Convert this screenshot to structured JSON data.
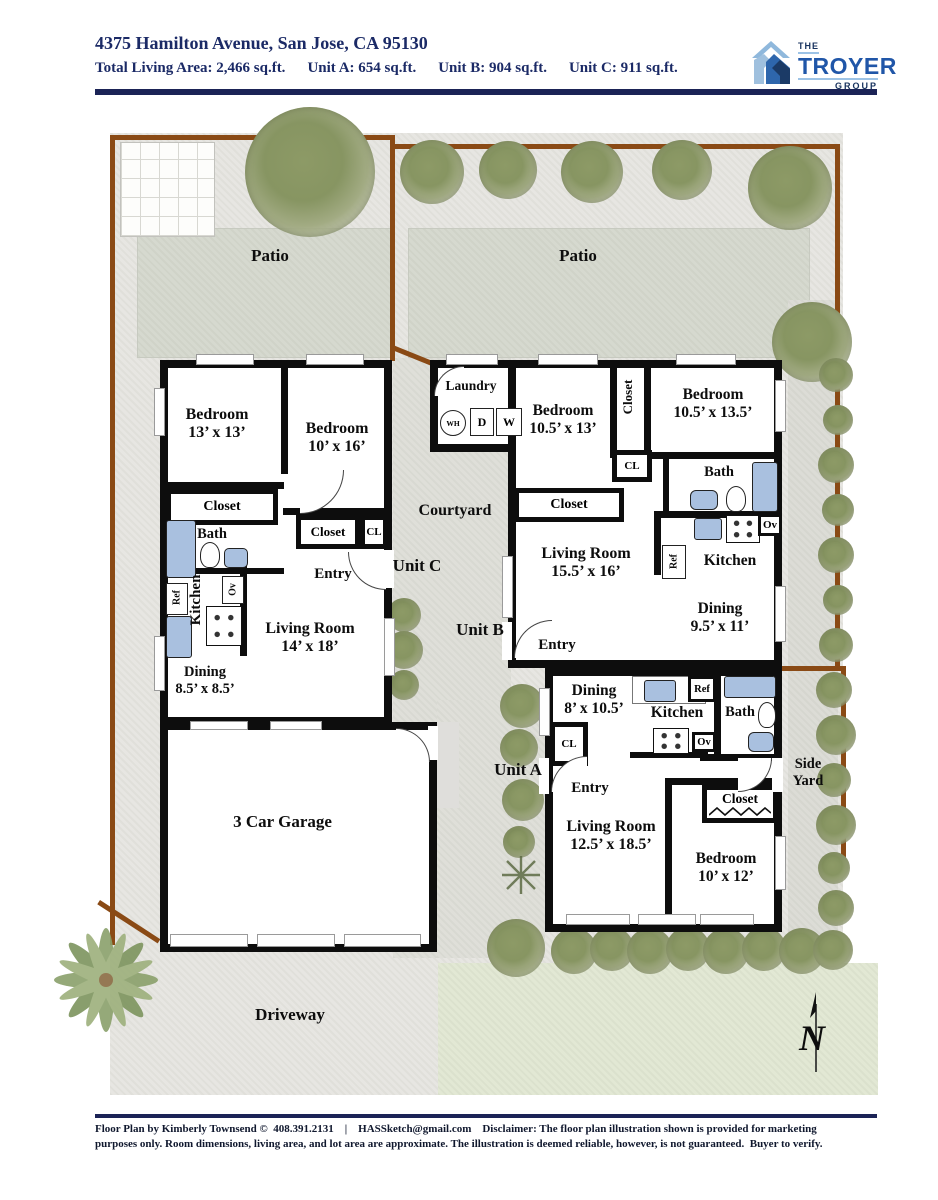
{
  "header": {
    "address": "4375 Hamilton Avenue, San Jose, CA 95130",
    "stats": [
      "Total Living Area: 2,466 sq.ft.",
      "Unit A: 654 sq.ft.",
      "Unit B: 904 sq.ft.",
      "Unit C: 911 sq.ft."
    ],
    "logo": {
      "line1": "THE",
      "line2": "TROYER",
      "line3": "GROUP"
    }
  },
  "site": {
    "patio_left": "Patio",
    "patio_right": "Patio",
    "courtyard": "Courtyard",
    "driveway": "Driveway",
    "side_yard": "Side Yard",
    "garage": "3 Car Garage",
    "compass_n": "N"
  },
  "unit_c": {
    "label": "Unit C",
    "bedroom1": {
      "name": "Bedroom",
      "dims": "13’ x 13’"
    },
    "bedroom2": {
      "name": "Bedroom",
      "dims": "10’ x 16’"
    },
    "closet1": "Closet",
    "bath": "Bath",
    "kitchen": "Kitchen",
    "ref": "Ref",
    "ov": "Ov",
    "dining": {
      "name": "Dining",
      "dims": "8.5’ x 8.5’"
    },
    "living": {
      "name": "Living Room",
      "dims": "14’ x 18’"
    },
    "entry": "Entry",
    "closet2": "Closet",
    "cl": "CL"
  },
  "unit_b": {
    "label": "Unit B",
    "laundry": "Laundry",
    "wh": "WH",
    "d": "D",
    "w": "W",
    "bedroom1": {
      "name": "Bedroom",
      "dims": "10.5’ x 13’"
    },
    "closet_tall": "Closet",
    "cl": "CL",
    "bedroom2": {
      "name": "Bedroom",
      "dims": "10.5’ x 13.5’"
    },
    "bath": "Bath",
    "closet": "Closet",
    "living": {
      "name": "Living Room",
      "dims": "15.5’ x 16’"
    },
    "kitchen": "Kitchen",
    "ref": "Ref",
    "ov": "Ov",
    "dining": {
      "name": "Dining",
      "dims": "9.5’ x 11’"
    },
    "entry": "Entry"
  },
  "unit_a": {
    "label": "Unit A",
    "dining": {
      "name": "Dining",
      "dims": "8’ x 10.5’"
    },
    "kitchen": "Kitchen",
    "ref": "Ref",
    "ov": "Ov",
    "bath": "Bath",
    "cl": "CL",
    "entry": "Entry",
    "living": {
      "name": "Living Room",
      "dims": "12.5’ x 18.5’"
    },
    "bedroom": {
      "name": "Bedroom",
      "dims": "10’ x 12’"
    },
    "closet": "Closet"
  },
  "footer": {
    "text": "Floor Plan by Kimberly Townsend ©  408.391.2131    |    HASSketch@gmail.com    Disclaimer: The floor plan illustration shown is provided for marketing purposes only. Room dimensions, living area, and lot area are approximate. The illustration is deemed reliable, however, is not guaranteed.  Buyer to verify."
  },
  "colors": {
    "accent_navy": "#1b2a66",
    "rule_navy": "#1b2356",
    "logo_blue": "#2056a8",
    "logo_light_blue": "#8fb8dc",
    "wall_black": "#0d0d0d",
    "fence_brown": "#8a4a15",
    "fixture_blue": "#a9c0df"
  }
}
